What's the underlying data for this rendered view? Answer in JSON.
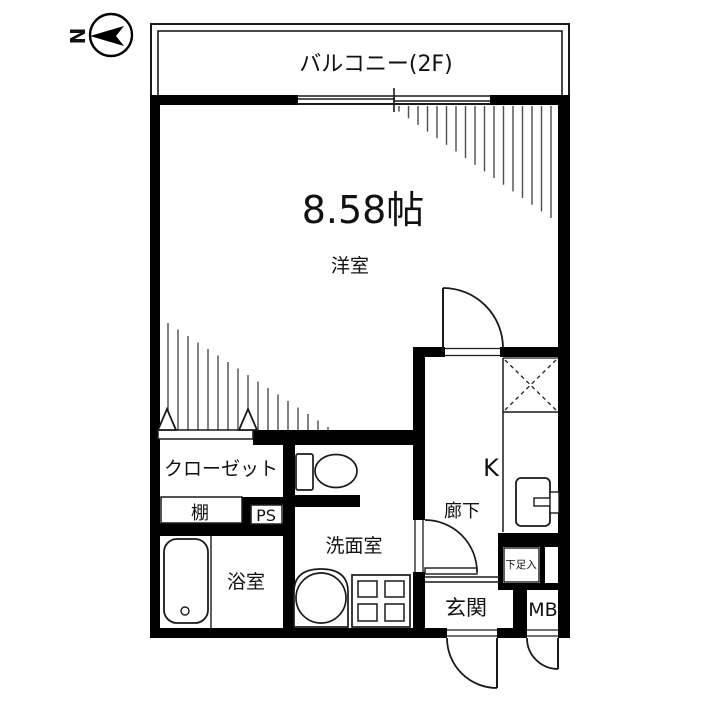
{
  "plan_title": "1R apartment floor plan",
  "compass": {
    "north_label": "N"
  },
  "balcony": {
    "label": "バルコニー(2F)"
  },
  "living_room": {
    "area_label": "8.58帖",
    "name_label": "洋室"
  },
  "closet": {
    "name_label": "クローゼット"
  },
  "shelf": {
    "name_label": "棚"
  },
  "pipe_space": {
    "name_label": "PS"
  },
  "bathroom": {
    "name_label": "浴室"
  },
  "washroom": {
    "name_label": "洗面室"
  },
  "hallway": {
    "name_label": "廊下"
  },
  "kitchen": {
    "name_label": "K"
  },
  "entrance": {
    "name_label": "玄関"
  },
  "shoe_cabinet": {
    "name_label": "下足入"
  },
  "meter_box": {
    "name_label": "MB"
  },
  "colors": {
    "wall": "#000000",
    "hatch_line": "#4d4d4d",
    "background": "#ffffff",
    "text": "#111111"
  }
}
